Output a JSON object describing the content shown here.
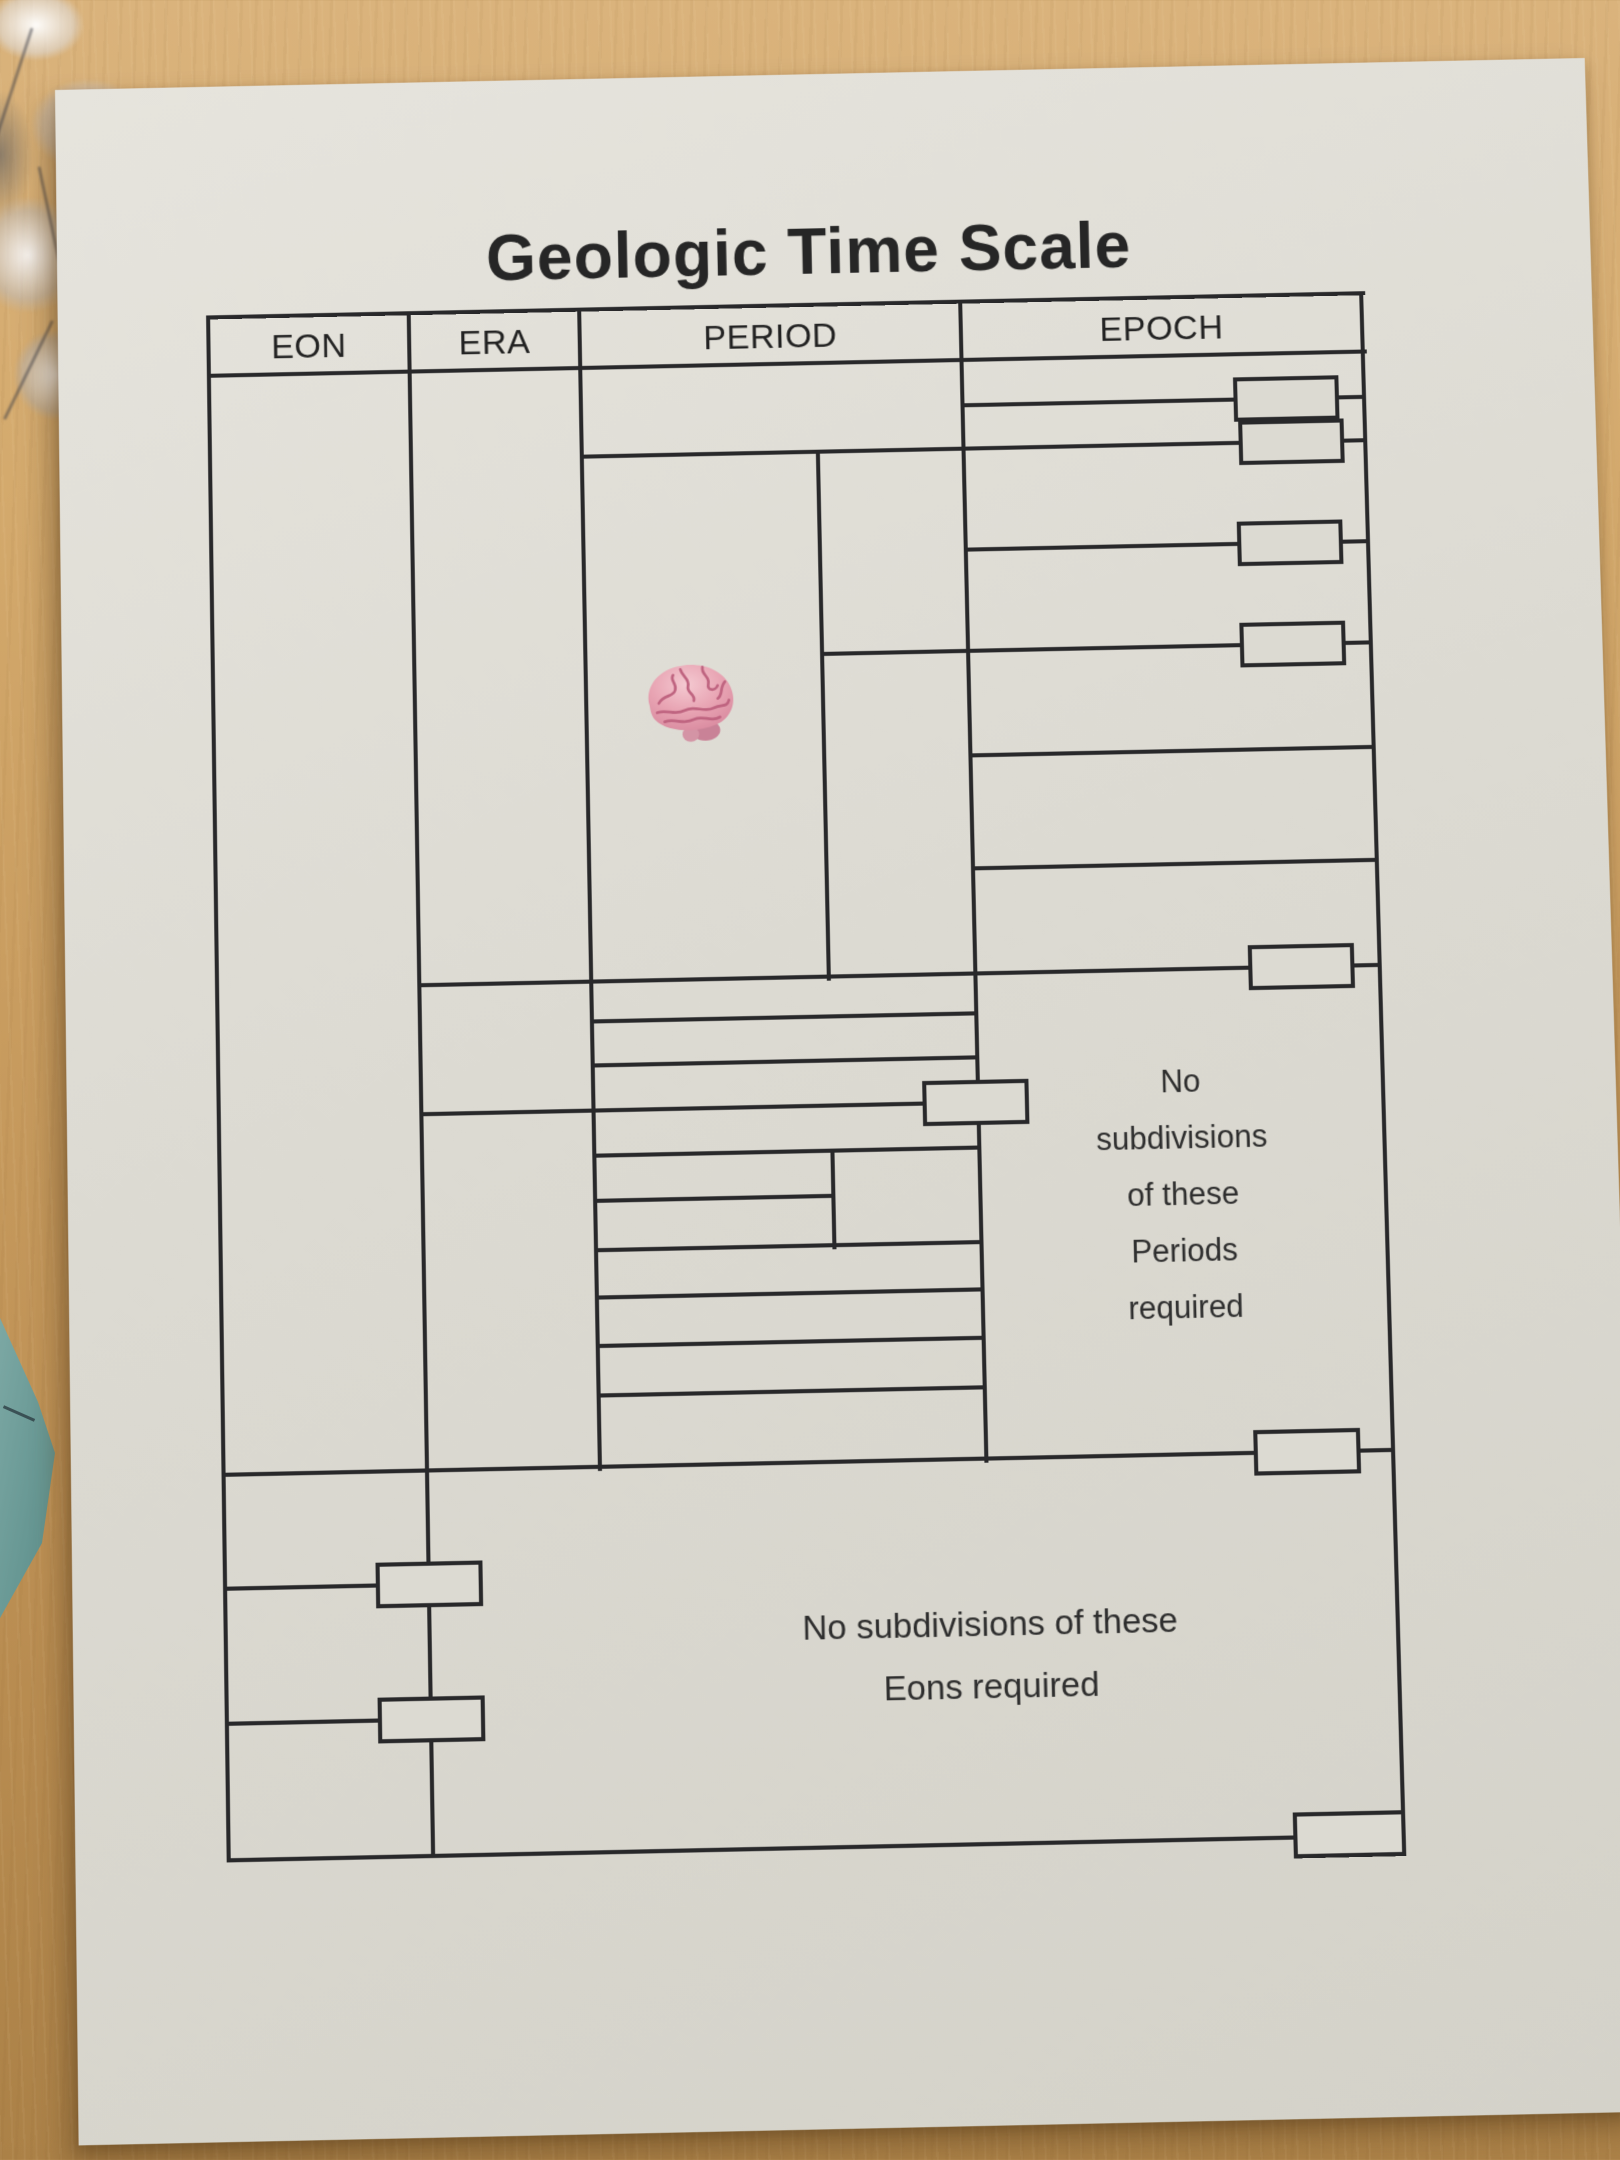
{
  "scene": {
    "desk_color": "#c99d60",
    "worksheet_paper_color": "#dcdad2",
    "grid_line_color": "#28282a",
    "teal_paper_color": "#6f9e9b",
    "brain_sticker_color": "#e59aab"
  },
  "document": {
    "title": "Geologic Time Scale",
    "headers": [
      "EON",
      "ERA",
      "PERIOD",
      "EPOCH"
    ],
    "notes": {
      "periods": [
        "No",
        "subdivisions",
        "of these",
        "Periods",
        "required"
      ],
      "eons": [
        "No subdivisions of these",
        "Eons required"
      ]
    }
  }
}
